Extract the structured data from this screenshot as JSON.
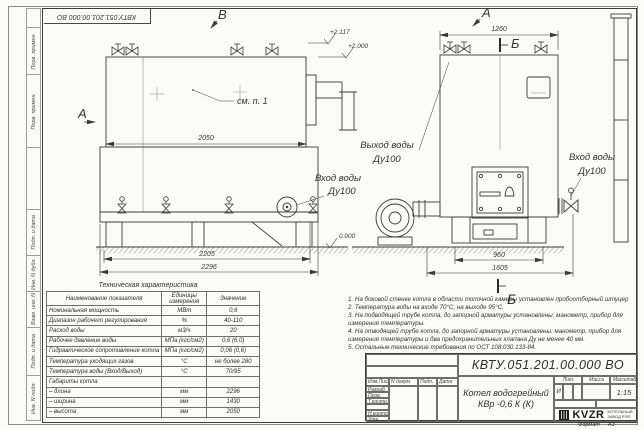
{
  "frame": {
    "doc_number_mirrored": "КВТУ.051.201.00.000  ВО",
    "format_label": "Формат",
    "format_value": "А3",
    "margin_cells": [
      {
        "label": "Перв. примен."
      },
      {
        "label": "Перв. примен."
      },
      {
        "label": "Подп. и дата"
      },
      {
        "label": "Инв. N дубл."
      },
      {
        "label": "Взам. инв. N"
      },
      {
        "label": "Подп. и дата"
      },
      {
        "label": "Инв. N подл."
      }
    ]
  },
  "views": {
    "label_v": "В",
    "label_a_left": "А",
    "label_a_top": "А",
    "label_b_top": "Б",
    "label_b_bottom": "Б",
    "callout_see_note": "см. п. 1",
    "elev_2117": "+2.117",
    "elev_2000": "+2.000",
    "elev_0000": "0.000",
    "dim_2050": "2050",
    "dim_2205": "2205",
    "dim_2296": "2296",
    "dim_1260": "1260",
    "dim_960": "960",
    "dim_1605": "1605",
    "outlet_line1": "Выход воды",
    "outlet_line2": "Ду100",
    "inlet_mid_line1": "Вход воды",
    "inlet_mid_line2": "Ду100",
    "inlet_right_line1": "Вход воды",
    "inlet_right_line2": "Ду100"
  },
  "tech_table": {
    "title": "Техническая характеристика",
    "col_name": "Наименование показателя",
    "col_units_line1": "Единицы",
    "col_units_line2": "измерения",
    "col_value": "Значение",
    "rows": [
      {
        "name": "Номинальная мощность",
        "units": "МВт",
        "value": "0,6"
      },
      {
        "name": "Диапазон рабочего регулирования",
        "units": "%",
        "value": "40-110"
      },
      {
        "name": "Расход воды",
        "units": "м3/ч",
        "value": "20"
      },
      {
        "name": "Рабочее давление воды",
        "units": "МПа (кгс/см2)",
        "value": "0,6 (6,0)"
      },
      {
        "name": "Гидравлическое сопротивление котла",
        "units": "МПа (кгс/см2)",
        "value": "0,06 (0,6)"
      },
      {
        "name": "Температура уходящих газов",
        "units": "°С",
        "value": "не более 280"
      },
      {
        "name": "Температура воды (Вход/Выход)",
        "units": "°С",
        "value": "70/95"
      },
      {
        "name": "Габариты котла",
        "units": "",
        "value": ""
      },
      {
        "name": "– длина",
        "units": "мм",
        "value": "2296"
      },
      {
        "name": "– ширина",
        "units": "мм",
        "value": "1430"
      },
      {
        "name": "– высота",
        "units": "мм",
        "value": "2050"
      }
    ]
  },
  "notes": [
    "1.  На боковой стенке котла в области топочной камеры установлен пробоотборный штуцер",
    "2.  Температура воды на входе 70°С, на выходе 95°С.",
    "3.  На подводящей трубе котла, до запорной арматуры установлены: манометр, прибор для",
    "измерения температуры.",
    "4.  На отводящей трубе котла, до запорной арматуры установлены: манометр, прибор для",
    "измерения температуры и два предохранительных клапана Ду не менее 40 мм.",
    "5.  Остальные технические требования по ОСТ 108.030.133-84."
  ],
  "title_block": {
    "doc_number": "КВТУ.051.201.00.000  ВО",
    "name_line1": "Котел водогрейный",
    "name_line2": "КВр -0,6  К  (К)",
    "cols": [
      "Изм.Лист",
      "N докум.",
      "Подп.",
      "Дата"
    ],
    "row_labels": [
      "Разраб.",
      "Пров.",
      "Т.контр.",
      "",
      "Н.контр.",
      "Утв."
    ],
    "lit_label": "Лит.",
    "lit_value": "И",
    "mass_label": "Масса",
    "scale_label": "Масштаб",
    "scale_value": "1:15",
    "sheet_label": "Лист",
    "sheet_num": "1",
    "sheets_label": "Листов",
    "sheets_num": "2",
    "logo_text": "KVZR",
    "logo_sub_line1": "КОТЕЛЬНЫЙ",
    "logo_sub_line2": "ЗАВОД РЭП"
  }
}
